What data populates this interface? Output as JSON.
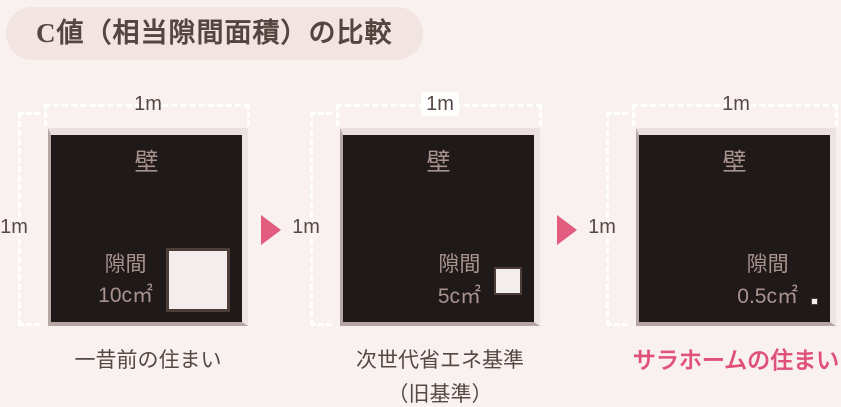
{
  "title": "C値（相当隙間面積）の比較",
  "panels": [
    {
      "caption": "一昔前の住まい",
      "caption_line2": "",
      "wall_label": "壁",
      "gap_label": "隙間",
      "gap_value": "10c㎡",
      "top_dim": "1m",
      "left_dim": "1m"
    },
    {
      "caption": "次世代省エネ基準",
      "caption_line2": "（旧基準）",
      "wall_label": "壁",
      "gap_label": "隙間",
      "gap_value": "5c㎡",
      "top_dim": "1m",
      "left_dim": "1m"
    },
    {
      "caption": "サラホームの住まい",
      "caption_line2": "",
      "wall_label": "壁",
      "gap_label": "隙間",
      "gap_value": "0.5c㎡",
      "top_dim": "1m",
      "left_dim": "1m"
    }
  ],
  "colors": {
    "page_bg": "#f8f1f0",
    "pill_bg": "#f1e4e1",
    "dark_text": "#564843",
    "panel_fill": "#201919",
    "inner_text": "#a8938f",
    "gap_fill": "#f3eded",
    "gap_border": "#4d3d39",
    "accent_pink": "#e25c80",
    "highlight_caption": "#e0517a",
    "dotted_line": "#ffffff"
  }
}
